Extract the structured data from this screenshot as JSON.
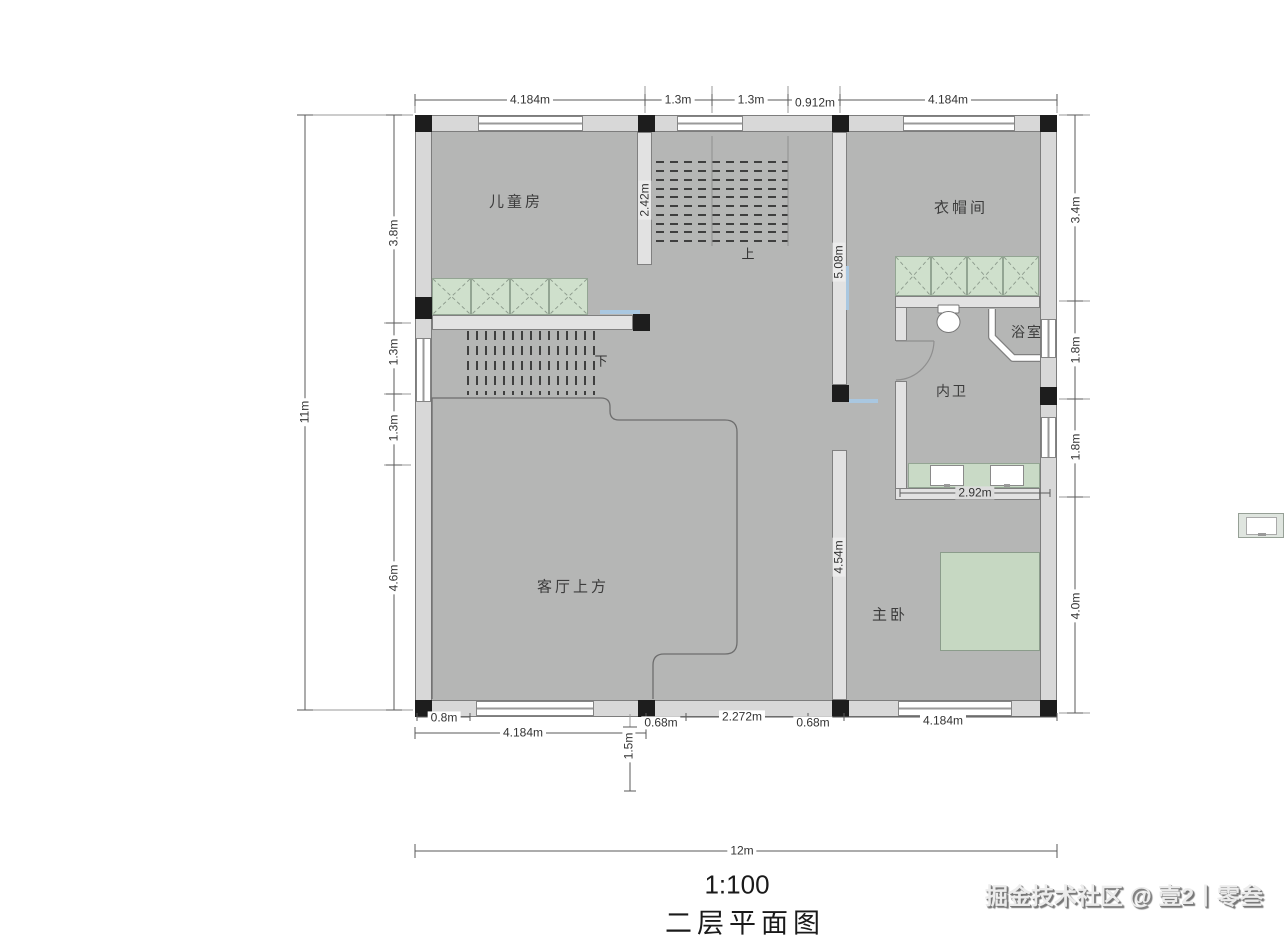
{
  "plan": {
    "title": "二层平面图",
    "scale_label": "1:100",
    "watermark": "掘金技术社区 @ 壹2丨零叁",
    "rooms": [
      {
        "name": "儿童房"
      },
      {
        "name": "衣帽间"
      },
      {
        "name": "浴室"
      },
      {
        "name": "内卫"
      },
      {
        "name": "客厅上方"
      },
      {
        "name": "主卧"
      }
    ],
    "stairs": {
      "up_label": "上",
      "down_label": "下"
    },
    "dims": {
      "top": [
        "4.184m",
        "1.3m",
        "1.3m",
        "0.912m",
        "4.184m"
      ],
      "left_total": "11m",
      "left": [
        "3.8m",
        "1.3m",
        "1.3m",
        "4.6m"
      ],
      "right": [
        "3.4m",
        "1.8m",
        "1.8m",
        "4.0m"
      ],
      "bottom_row1": [
        "0.8m",
        "0.68m",
        "2.272m",
        "0.68m",
        "4.184m"
      ],
      "bottom_row2": [
        "4.184m",
        "1.5m"
      ],
      "bottom_total": "12m",
      "interior": [
        "2.42m",
        "5.08m",
        "4.54m",
        "2.92m"
      ]
    }
  }
}
